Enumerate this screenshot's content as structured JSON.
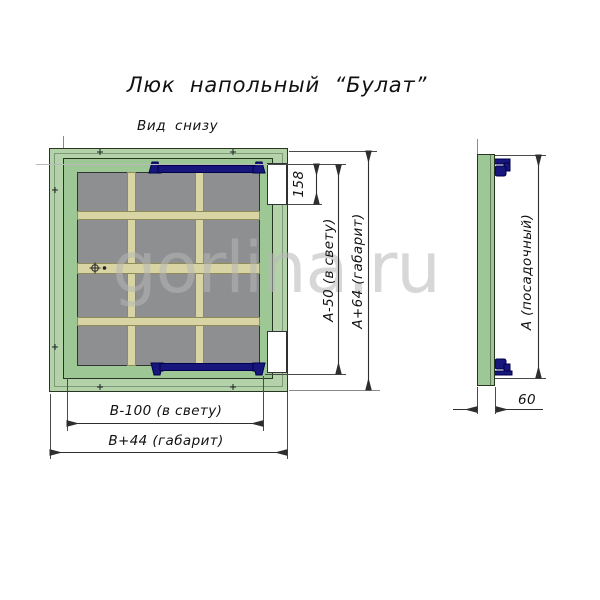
{
  "title": "Люк напольный “Булат”",
  "view_label": "Вид снизу",
  "watermark": "gorlina.ru",
  "colors": {
    "frame_green": "#b3d2aa",
    "lid_green": "#9dc795",
    "panel_gray": "#8e8f91",
    "rib_beige": "#d8d4a4",
    "hinge_navy": "#16167d",
    "dimension_line": "#333333",
    "watermark_gray": "#b7b7b7"
  },
  "bottom_view": {
    "dim_hinge_cutout": "158",
    "dim_clear_height": "А-50 (в свету)",
    "dim_overall_height": "А+64 (габарит)",
    "dim_clear_width": "В-100 (в свету)",
    "dim_overall_width": "В+44 (габарит)"
  },
  "side_view": {
    "dim_seat_height": "А (посадочный)",
    "dim_depth": "60"
  }
}
